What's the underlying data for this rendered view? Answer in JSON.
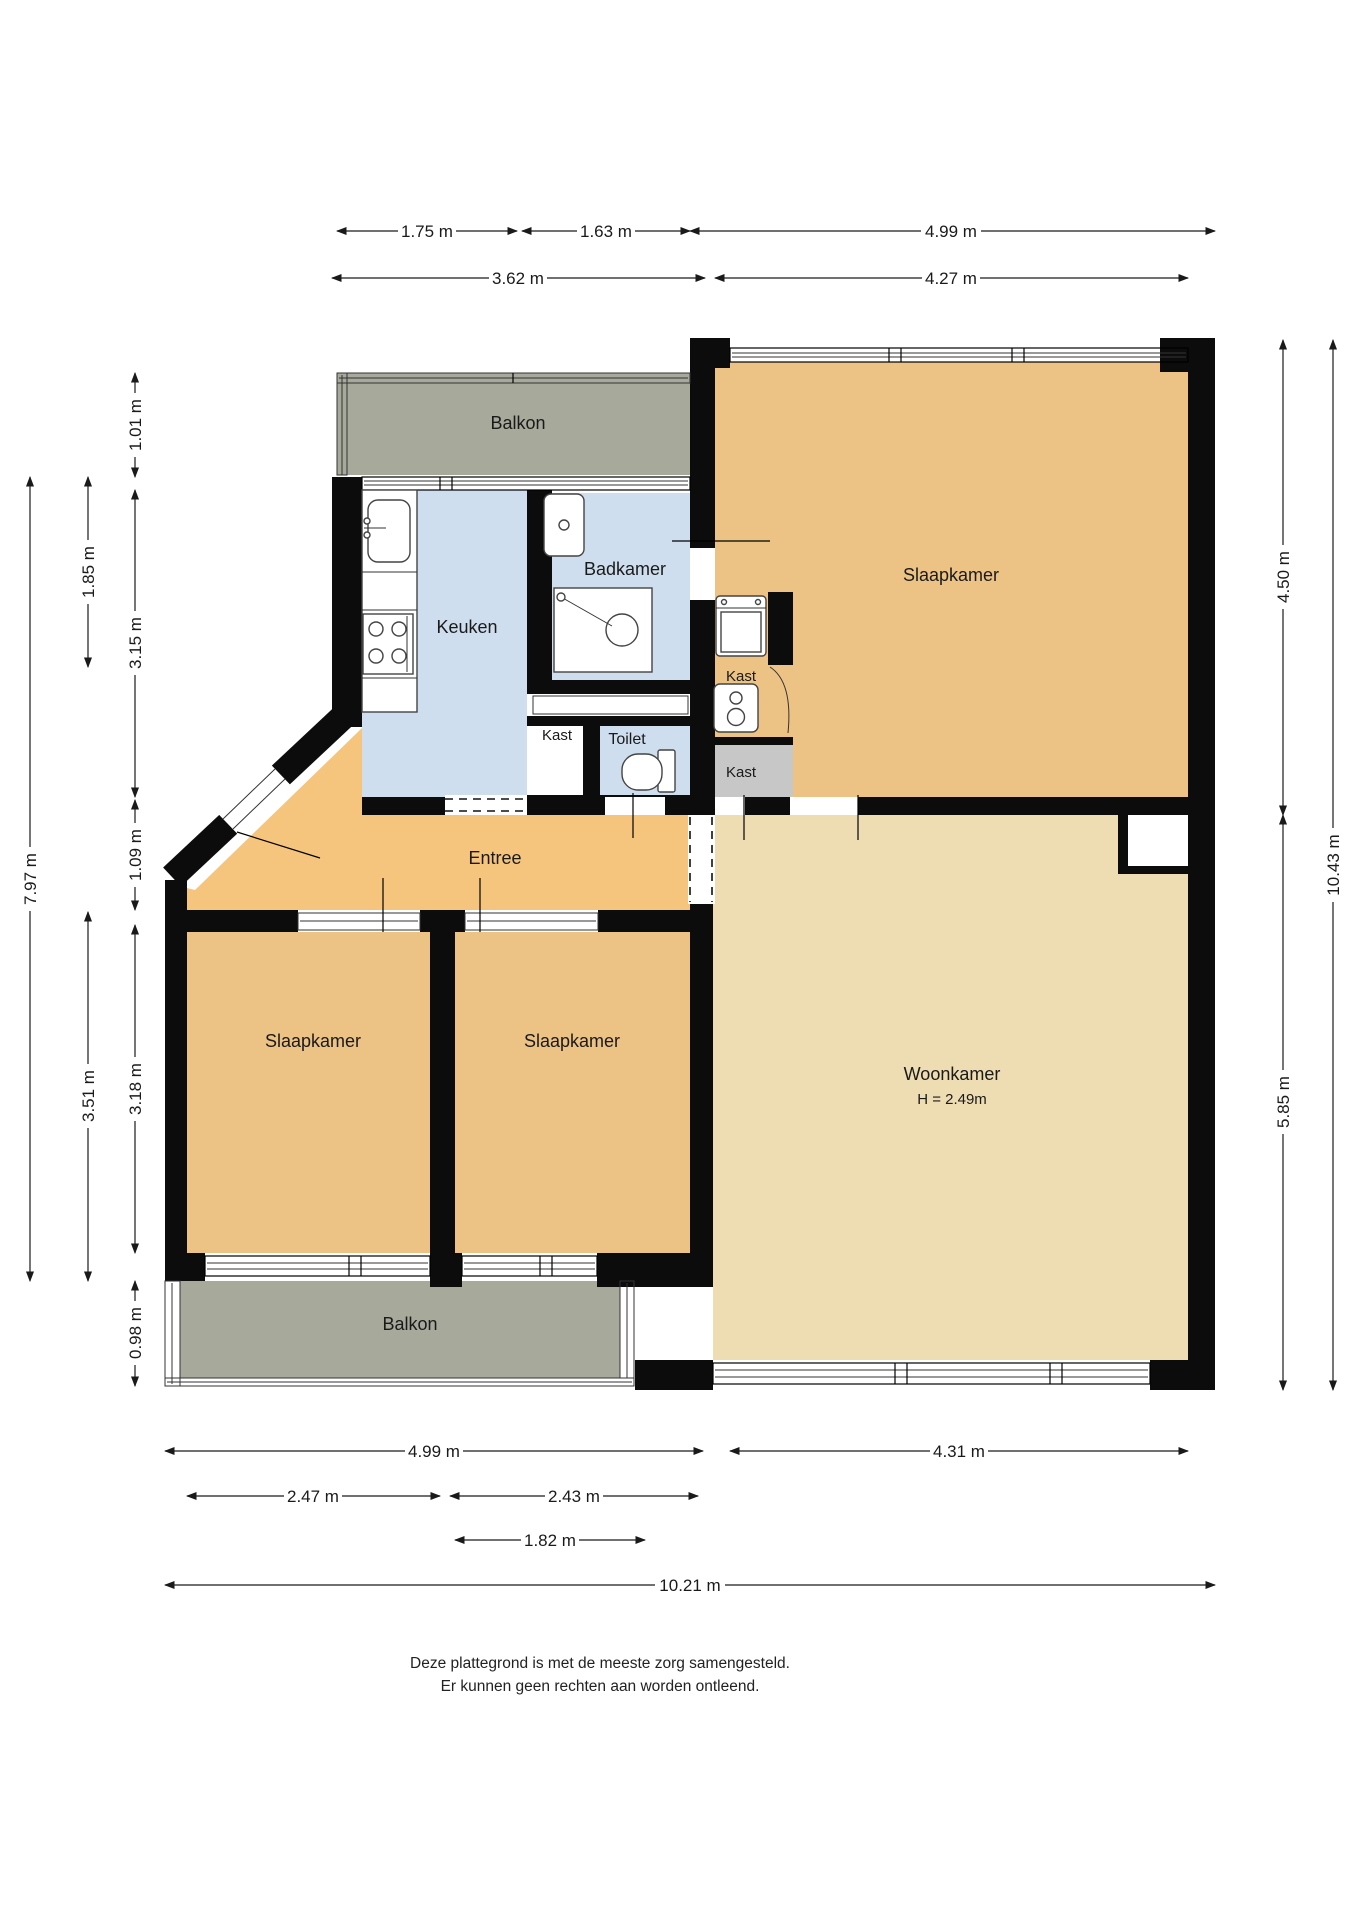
{
  "plan": {
    "rooms": {
      "balkon_top": "Balkon",
      "keuken": "Keuken",
      "badkamer": "Badkamer",
      "slaapkamer_topright": "Slaapkamer",
      "kast_washer": "Kast",
      "kast_hall": "Kast",
      "kast_gray": "Kast",
      "toilet": "Toilet",
      "entree": "Entree",
      "slaapkamer_left": "Slaapkamer",
      "slaapkamer_middle": "Slaapkamer",
      "woonkamer": "Woonkamer",
      "woonkamer_ceiling_height": "H = 2.49m",
      "balkon_bottom": "Balkon"
    },
    "dimensions": {
      "top_row1": [
        "1.75 m",
        "1.63 m",
        "4.99 m"
      ],
      "top_row2": [
        "3.62 m",
        "4.27 m"
      ],
      "bottom_row1": [
        "4.99 m",
        "4.31 m"
      ],
      "bottom_row2": [
        "2.47 m",
        "2.43 m"
      ],
      "bottom_row3": [
        "1.82 m"
      ],
      "bottom_row4": [
        "10.21 m"
      ],
      "left_col1": [
        "7.97 m"
      ],
      "left_col2": [
        "1.85 m",
        "3.51 m"
      ],
      "left_col3": [
        "1.01 m",
        "3.15 m",
        "1.09 m",
        "3.18 m",
        "0.98 m"
      ],
      "right_col1": [
        "4.50 m",
        "5.85 m"
      ],
      "right_col2": [
        "10.43 m"
      ]
    },
    "colors": {
      "bedroom_tan": "#ecc285",
      "livingroom_tan": "#eedcb2",
      "entry_orange": "#f6c57d",
      "wet_room_blue": "#cfdeee",
      "balcony_gray": "#a7a99b",
      "closet_gray": "#c7c7c7",
      "wall_black": "#0c0c0c"
    },
    "icons": {
      "kitchen_sink": "kitchen-sink-icon",
      "stove": "stove-icon",
      "bathroom_sink": "bathroom-sink-icon",
      "shower": "shower-icon",
      "toilet": "toilet-icon",
      "washing_machine": "washing-machine-icon",
      "boiler": "boiler-icon",
      "dimension_arrow": "arrow-icon"
    },
    "footer": {
      "line1": "Deze plattegrond is met de meeste zorg samengesteld.",
      "line2": "Er kunnen geen rechten aan worden ontleend."
    }
  }
}
